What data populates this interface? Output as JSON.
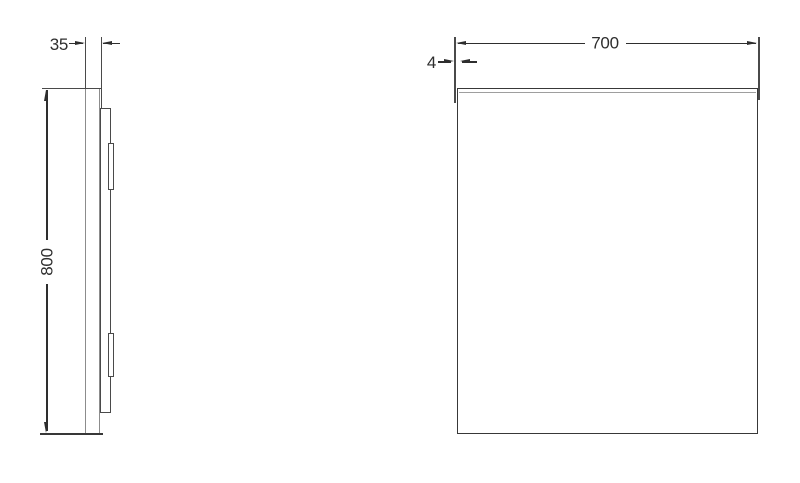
{
  "drawing": {
    "side_view": {
      "depth_label": "35",
      "height_label": "800"
    },
    "front_view": {
      "width_label": "700",
      "thickness_label": "4"
    }
  },
  "colors": {
    "line": "#4a4a4a",
    "line-dark": "#383838",
    "line-gray": "#9e9e9e",
    "dim": "#2e2e2e",
    "bg": "#ffffff"
  }
}
